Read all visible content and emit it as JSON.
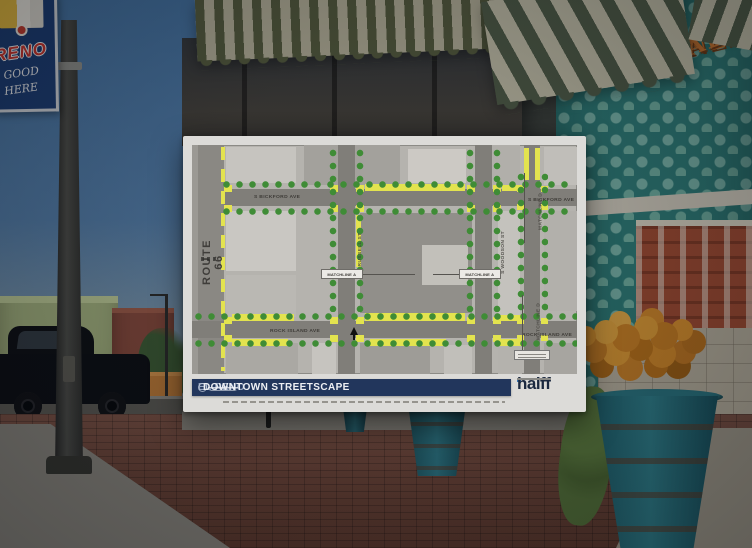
{
  "scene": {
    "banner": {
      "title": "RENO",
      "script_line1": "S GOOD",
      "script_line2": "E HERE"
    },
    "mural_sign": {
      "line1": "BRONZE",
      "line2": "SEAL"
    }
  },
  "poster": {
    "title": {
      "prefix": "EL RENO",
      "main": "DOWNTOWN STREETSCAPE"
    },
    "brand": {
      "name": "halff"
    },
    "map": {
      "labels": {
        "route_66": "ROUTE 66",
        "bickford_left": "S BICKFORD AVE",
        "bickford_right": "S BICKFORD AVE",
        "rock_island_left": "ROCK ISLAND AVE",
        "rock_island_right": "ROCK ISLAND AVE",
        "matchline_a_left": "MATCHLINE A",
        "matchline_a_right": "MATCHLINE A",
        "matchline_d_top": "MATCHLINE D",
        "matchline_d_bottom": "MATCHLINE D",
        "street_mid_vertical": "RUSSELL ST",
        "street_right_vertical": "S WOODSON ST"
      }
    }
  },
  "colors": {
    "poster_bar_navy": "#22365c",
    "halff_blue": "#3a77b3",
    "streetscape_yellow": "#e3e34f",
    "tree_green": "#3f8c36",
    "teal_wall": "#2e7b76",
    "banner_blue": "#1c3c72",
    "bronze_sign_orange": "#c2702c",
    "brick_sidewalk": "#6b4336"
  }
}
